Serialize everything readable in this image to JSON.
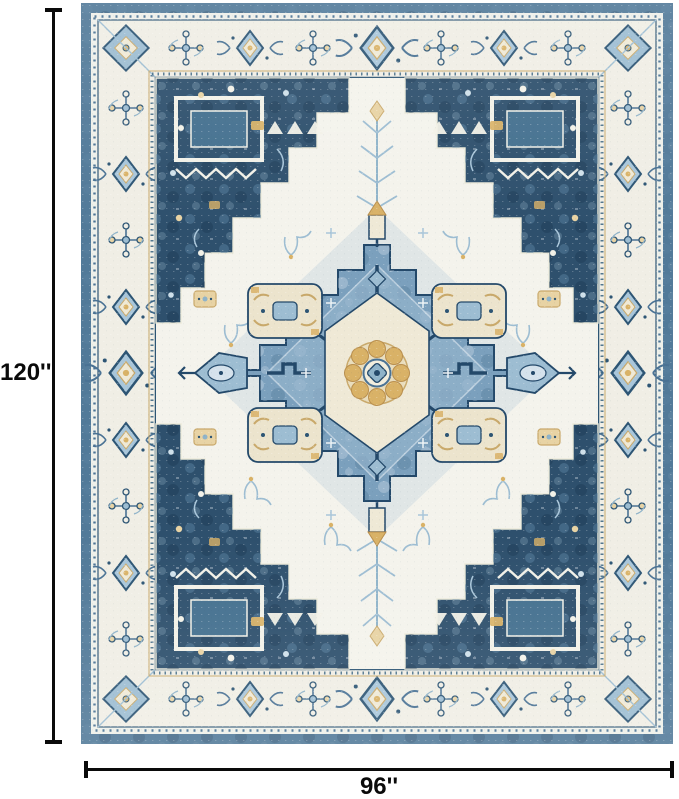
{
  "annotations": {
    "height_label": "120''",
    "width_label": "96''",
    "line_color": "#0a0a0a",
    "label_color": "#0a0a0a"
  },
  "image": {
    "subject": "vintage-heriz-medallion-area-rug",
    "background": "#ffffff",
    "palette": {
      "outer_band_blue": "#527a99",
      "border_ivory": "#f0eee5",
      "field_ivory": "#f4f3ec",
      "corner_navy": "#2e506d",
      "medallion_blue": "#7ba0bd",
      "light_blue": "#a9c6da",
      "pale_blue": "#d5e2ec",
      "gold": "#d9b267",
      "pale_gold": "#e8d3a4",
      "cream": "#ece4cd",
      "outline_navy": "#24496a",
      "tan": "#c9a96b"
    }
  }
}
